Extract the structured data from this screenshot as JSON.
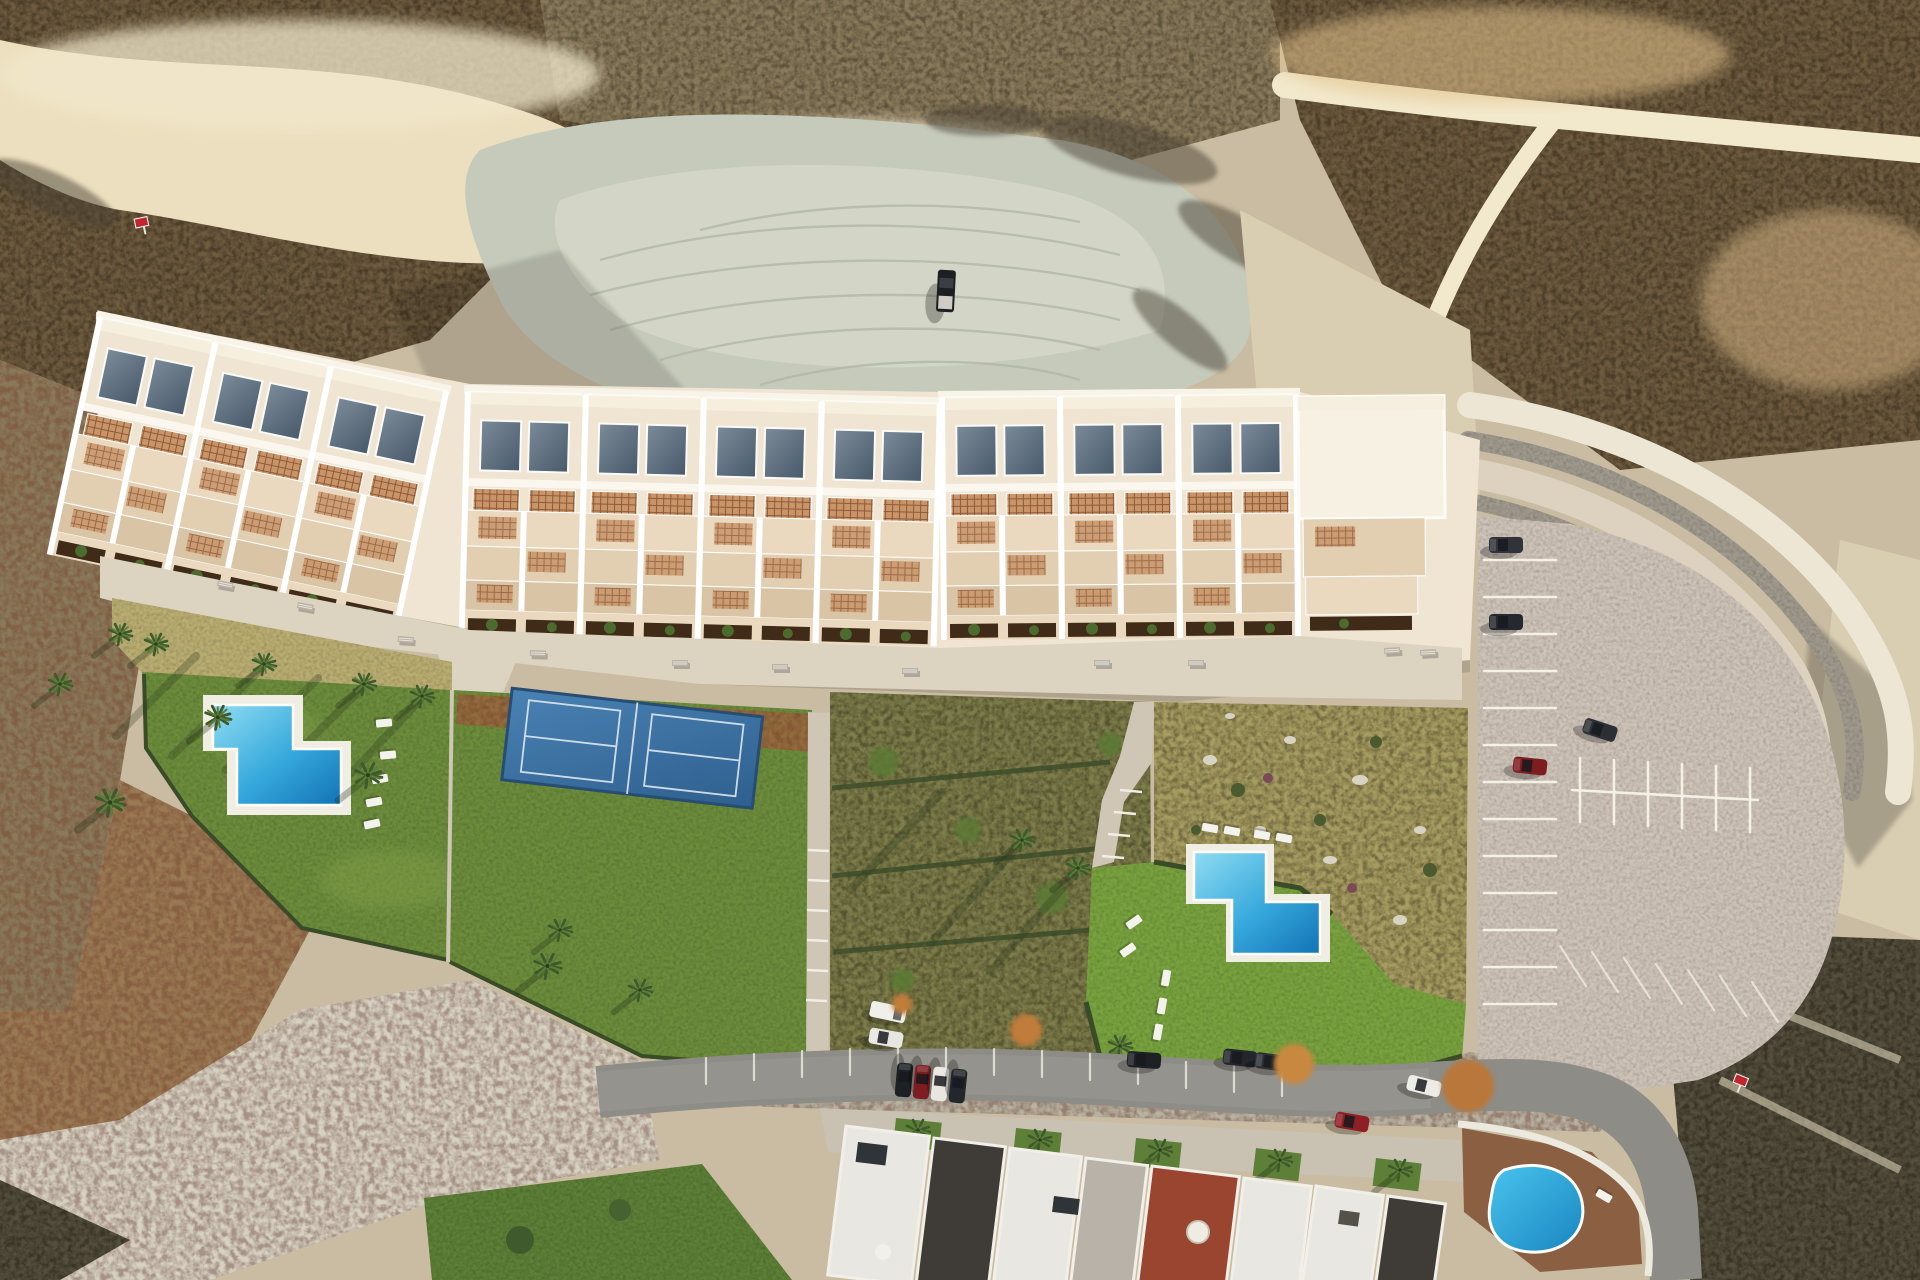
{
  "meta": {
    "title": "Aerial drone view at dusk of a new hillside residential development: a long stepped row of white terraced apartments with roof skylights and terracotta pergolas, communal lawns with two L-shaped swimming pools, a double padel court, a curved gabion-terraced parking lot, dry badlands terrain all around, and an existing street of houses with a round pool at the bottom"
  },
  "colors": {
    "sand": "#c9bca2",
    "sand2": "#d9cdb2",
    "cream": "#ecdfbf",
    "cream2": "#f2e8cb",
    "wash": "#c6cabb",
    "wash2": "#d7d1c2",
    "track": "#b2b8a7",
    "scrub": "#6e5c40",
    "scrub2": "#8a7a5c",
    "scrubDark": "#55503c",
    "rustland": "#9a7a55",
    "olive": "#7e7d4c",
    "drygrass": "#b9ad72",
    "drygrass2": "#a79d62",
    "lawn": "#6d8d3d",
    "lawn2": "#79a23f",
    "lawn3": "#5d7f37",
    "hedge": "#3a4b28",
    "mulch": "#926d3e",
    "roof": "#efe5d2",
    "roofBright": "#f7f1e3",
    "terr1": "#ead9bf",
    "terr2": "#e2cfb2",
    "terr3": "#d9c5a6",
    "planter": "#402a18",
    "bush": "#4e6b2f",
    "pergola": "#c89468",
    "pergolaLine": "#8f5a38",
    "walk": "#dcd3c1",
    "path": "#cfc6b5",
    "deck": "#f0ede2",
    "poolLight": "#8fdcf2",
    "poolMid": "#36a8dc",
    "poolDeep": "#1273b5",
    "roundPoolLight": "#49c4ee",
    "roundPoolDeep": "#1a85c0",
    "courtLight": "#4a82b4",
    "courtDark": "#2e5f8e",
    "lot": "#cec3b8",
    "gabion": "#a09a8e",
    "asphalt": "#8e8c86",
    "dirt2": "#b8b2a2",
    "houseWhite": "#e9e7e1",
    "houseCharcoal": "#3f3b37",
    "houseGray": "#b8b2a8",
    "houseRed": "#99452f",
    "houseRed2": "#8c4030",
    "poolDeckBrown": "#8a5f42",
    "palm": "#3c5a2b",
    "palmLight": "#5d7c36",
    "carDark": "#2c3036",
    "carBlack": "#1d2024",
    "carRed": "#7e1d20",
    "skyLight": "#7b8b99",
    "skyDark": "#48596a",
    "signRed": "#c0272d"
  },
  "scene": {
    "setting": "arid coastal badlands at golden hour, straight-down drone view",
    "development": {
      "residential_block": "stepped white terraced apartment row, 10 skylit units plus an end garage block",
      "amenities": [
        "west communal lawn with L-shaped swimming pool and sun loungers",
        "double padel court on blue sport surface",
        "central dry landscaped garden with palms",
        "east communal lawn with L-shaped swimming pool and sun loungers",
        "promenade walkway with benches",
        "curved parking lot with marked bays behind gabion retaining terraces"
      ],
      "counts": {
        "units": 10,
        "pools_new": 2,
        "padel_courts": 2,
        "benches": 11,
        "sun_loungers": 14,
        "cars_in_lot": 4
      }
    },
    "existing_neighbourhood": {
      "street": "curved asphalt street with perpendicular parking bays and about ten parked cars",
      "houses": "terrace of houses with white, charcoal and red-brown roofs, one with a white satellite dome",
      "round_pool": "kidney-shaped bright blue community pool ringed by brown deck"
    },
    "terrain_features": [
      "pale graded wash with circular tyre tracks and a parked dark pickup truck",
      "sunlit cream ridges and gullies",
      "dark scrub slopes with red-brown speckle",
      "three small red survey markers"
    ]
  }
}
